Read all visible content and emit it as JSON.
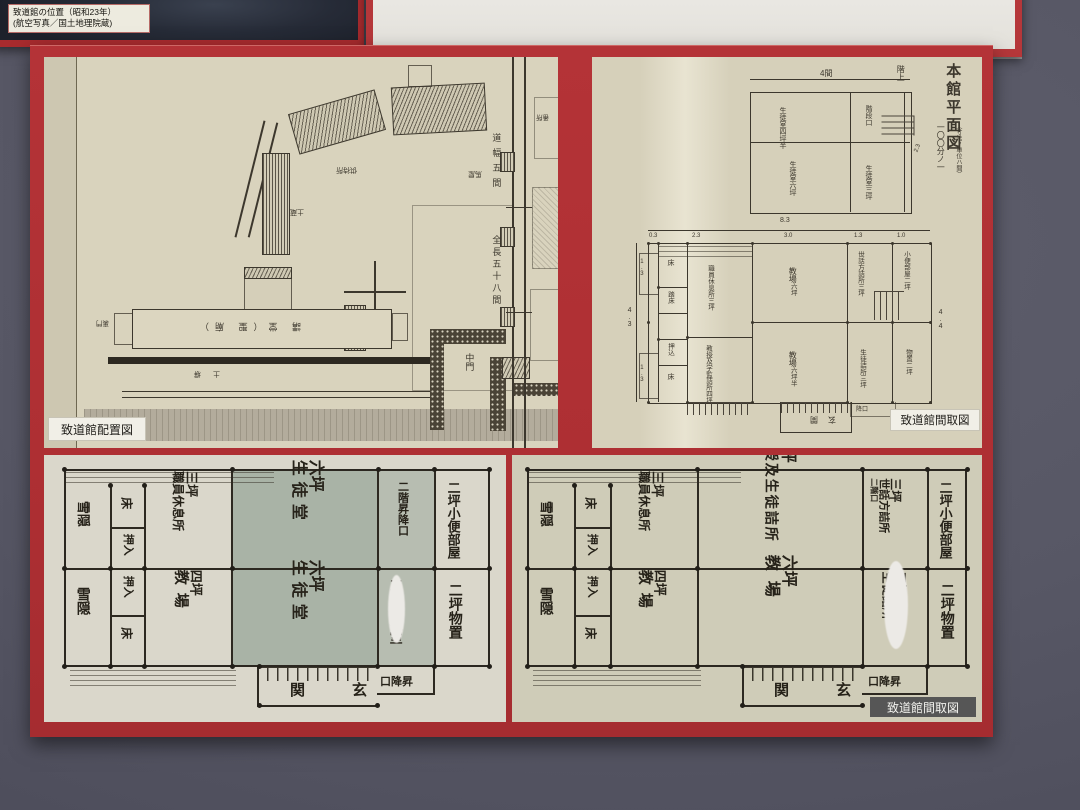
{
  "photo_label": {
    "line1": "致道館の位置（昭和23年）",
    "line2": "(航空写真／国土地理院蔵)"
  },
  "site": {
    "caption": "致道館配置図",
    "road_w": "道幅五間",
    "road_l": "全長五十八間",
    "nakamon": "中門",
    "umaya": "馬屋",
    "tomajo": "供待所",
    "dozo": "土蔵",
    "kodo": "講 堂（聖 廟）",
    "uramon": "裏門",
    "dobei": "土 塀",
    "hori": "堀",
    "bansho": "番所"
  },
  "printed": {
    "title": "本館平面図",
    "scale": "一〇〇分ノ一",
    "note": "（寸法ノ単位ハ間）",
    "kaijo": "階上",
    "caption": "致道館間取図",
    "up": {
      "d_top": "4間",
      "d_right": "2.3",
      "r1a": "生徒室",
      "r1b": "四坪半",
      "r2": "階段口",
      "r3a": "生徒室",
      "r3b": "六坪",
      "r4a": "生徒室",
      "r4b": "三坪"
    },
    "lo": {
      "d_total": "8.3",
      "s0": "0.3",
      "s1": "2.3",
      "s2": "3.0",
      "s3": "1.3",
      "s4": "1.0",
      "d_left": "4.3",
      "d_sub1": "1.3",
      "d_sub2": "1.3",
      "d_right": "4.4",
      "toko1": "床",
      "fumidoko": "踏床",
      "oshikomi": "押込",
      "toko2": "床",
      "staff_a": "職員休息所",
      "staff_b": "三坪",
      "ct_a": "教場",
      "ct_b": "六坪",
      "sew_a": "世話方詰所",
      "sew_b": "三坪",
      "ben_a": "小便部屋",
      "ben_b": "二坪",
      "kyo1": "教授及",
      "kyo2": "学監詰所",
      "kyo3": "四坪",
      "cb_a": "教場",
      "cb_b": "六坪半",
      "sei_a": "生徒詰所",
      "sei_b": "三坪",
      "mono_a": "物置",
      "mono_b": "二坪",
      "genkan": "玄関",
      "oriba": "降口"
    }
  },
  "hand_a": {
    "setchin_r": "雪隠",
    "toko1": "床",
    "oshi1": "押入",
    "staff_sz": "三坪",
    "staff": "職員休息所",
    "hallT_sz": "六坪",
    "hallT": "生徒堂",
    "stairs": "二階昇降口",
    "ben_sz": "二坪",
    "ben": "小便部屋",
    "setchin": "雪隠",
    "oshi2": "押入",
    "toko2": "床",
    "cls_sz": "四坪",
    "cls": "教場",
    "hallB_sz": "六坪",
    "hallB": "生徒堂",
    "sei_sz": "三坪",
    "sei": "生徒室",
    "mono_sz": "二坪",
    "mono": "物置",
    "genkan": "関　玄",
    "shoko": "口降昇"
  },
  "hand_b": {
    "caption": "致道館間取図",
    "setchin_r": "雪隠",
    "toko1": "床",
    "oshi1": "押入",
    "staff_sz": "三坪",
    "staff": "職員休息所",
    "hallT_sz": "六坪",
    "hallT": "教授及生徒詰所",
    "sew_sz": "三坪",
    "sew": "世話方詰所",
    "nikai": "二階口",
    "ben_sz": "二坪",
    "ben": "小便部屋",
    "setchin": "雪隠",
    "oshi2": "押入",
    "toko2": "床",
    "cls_sz": "四坪",
    "cls": "教場",
    "hallB_sz": "六坪",
    "hallB": "教場",
    "sei_sz": "三坪",
    "sei": "生徒詰所",
    "mono_sz": "二坪",
    "mono": "物置",
    "genkan": "関　玄",
    "shoko": "口降昇"
  }
}
